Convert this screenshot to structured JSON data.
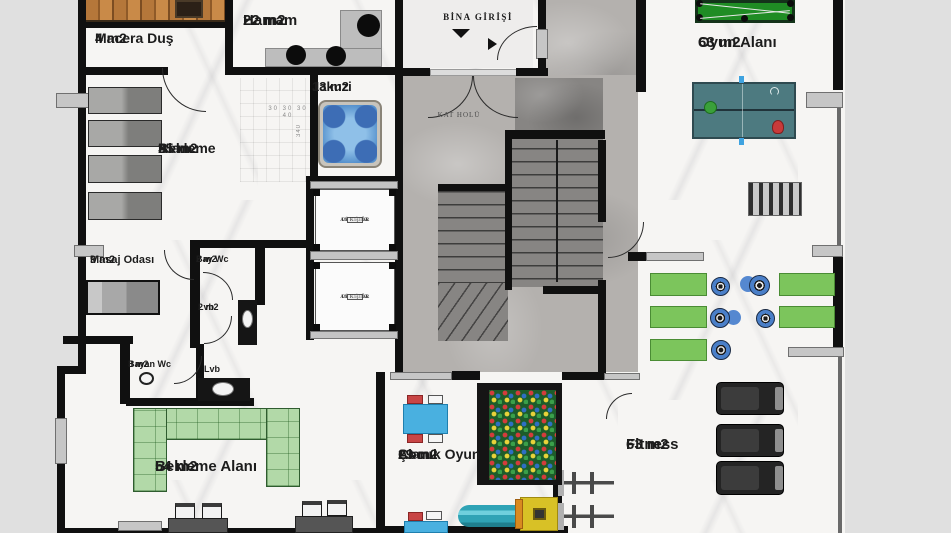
{
  "colors": {
    "wall": "#101010",
    "background": "#e0e0e0",
    "sofa_green": "#b2d9a8",
    "mat_green": "#7cc55c",
    "billiard_green": "#1f8c24",
    "pingpong_teal": "#4d7a80",
    "jacuzzi_blue": "#5b8fd0",
    "kids_table_blue": "#49b0e0",
    "chair_red": "#c84545",
    "slide_teal": "#2fa3b5",
    "slide_yellow": "#d8c126",
    "dumbbell_blue": "#4a7fc8",
    "treadmill_black": "#242424"
  },
  "rooms": {
    "macera_dus": {
      "name": "Macera Duş",
      "area": "4 m2"
    },
    "hamam": {
      "name": "Hamam",
      "area": "22 m2"
    },
    "jakuzi": {
      "name": "Jakuzi",
      "area": "13 m2"
    },
    "bekleme_ust": {
      "line1": "Bekleme",
      "line2": "Alanı",
      "area": "35 m2"
    },
    "masaj_odasi": {
      "name": "Masaj Odası",
      "area": "9 m2"
    },
    "bay_wc": {
      "name": "Bay Wc",
      "area": "2 m2"
    },
    "lvb_ust": {
      "name": "Lvb",
      "area": "2 m2"
    },
    "bayan_wc": {
      "name": "Bayan Wc",
      "area": "3 m2"
    },
    "lvb_alt": {
      "name": "Lvb"
    },
    "bekleme_alt": {
      "name": "Bekleme Alanı",
      "area": "54 m2"
    },
    "cocuk_oyun": {
      "line1": "Çocuk Oyun",
      "line2": "Alanı",
      "area": "29 m2"
    },
    "oyun_alani": {
      "name": "Oyun Alanı",
      "area": "63 m2"
    },
    "fitness": {
      "name": "Fitness",
      "area": "63 m2"
    },
    "bina_girisi": {
      "name": "BİNA GİRİŞİ"
    },
    "kat_holu": {
      "name": "KAT HOLÜ"
    }
  },
  "elevators": {
    "line1": "DİŞLİSİZ",
    "line2": "ASANSÖR",
    "capacity": "10 Kişilik"
  },
  "dimensions": {
    "jakuzi_widths": "30 30 30 40",
    "jakuzi_height": "340"
  }
}
